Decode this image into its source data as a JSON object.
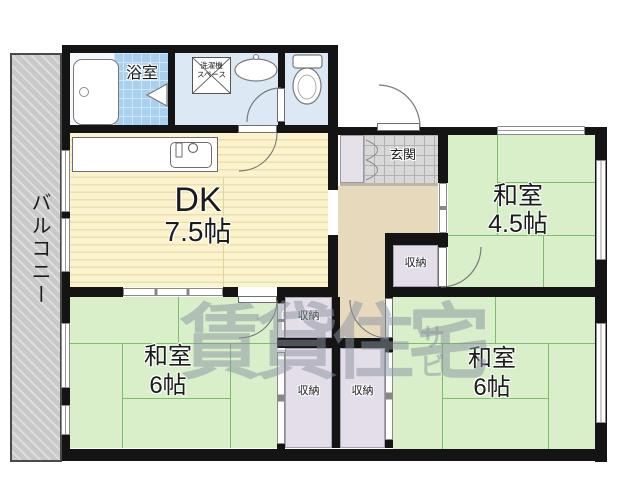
{
  "floorplan": {
    "balcony_label": "バルコニー",
    "bath_label": "浴室",
    "laundry_line1": "洗濯機",
    "laundry_line2": "スペース",
    "entrance_label": "玄関",
    "dk_name": "DK",
    "dk_size": "7.5帖",
    "room_ne_name": "和室",
    "room_ne_size": "4.5帖",
    "room_sw_name": "和室",
    "room_sw_size": "6帖",
    "room_se_name": "和室",
    "room_se_size": "6帖",
    "closet_ne_label": "収納",
    "closet_mid_label": "収納",
    "closet_sw_label": "収納",
    "closet_se_label": "収納",
    "watermark_main": "賃貸住宅",
    "watermark_sub1": "サ",
    "watermark_sub2": "ビ"
  },
  "colors": {
    "wall": "#141414",
    "tatami_green": "#d9efca",
    "tatami_line": "#7cbf68",
    "dk_floor": "#fbf3cd",
    "hallway_beige": "#e7dabc",
    "closet_lavender": "#e4dee9",
    "bath_tile_blue": "#a9d1ef",
    "sanitary_blue": "#dce9f5",
    "balcony_gray": "#c9c9c9",
    "genkan_tile": "#d8d8d8",
    "watermark_gray": "rgba(138,146,160,0.5)"
  }
}
